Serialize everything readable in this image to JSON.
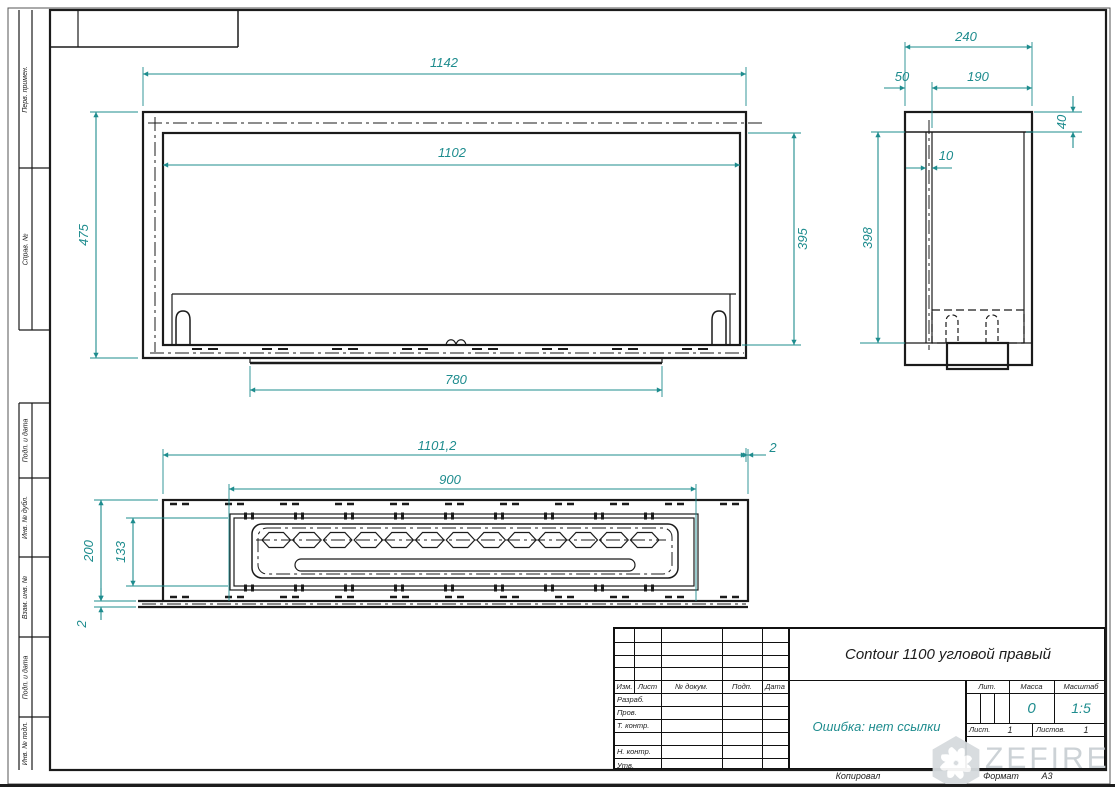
{
  "margin_labels": {
    "perv": "Перв. примен.",
    "sprav": "Справ. №",
    "podp1": "Подп. и дата",
    "inv_dubl": "Инв. № дубл.",
    "vzam": "Взам. инв. №",
    "podp2": "Подп. и дата",
    "inv_podl": "Инв. № подл."
  },
  "views": {
    "front": {
      "dim_width": "1142",
      "dim_inner_width": "1102",
      "dim_height": "475",
      "dim_inner_height": "395",
      "dim_bottom": "780"
    },
    "side": {
      "dim_depth": "240",
      "dim_50": "50",
      "dim_190": "190",
      "dim_40": "40",
      "dim_10": "10",
      "dim_height": "398"
    },
    "top": {
      "dim_length": "1101,2",
      "dim_burner": "900",
      "dim_right": "2",
      "dim_depth": "200",
      "dim_inner": "133",
      "dim_offset": "2"
    }
  },
  "title_block": {
    "title": "Contour 1100 угловой правый",
    "error_text": "Ошибка: нет ссылки",
    "col_izm": "Изм.",
    "col_list": "Лист",
    "col_dokum": "№ докум.",
    "col_podp": "Подп.",
    "col_data": "Дата",
    "row_razrab": "Разраб.",
    "row_prov": "Пров.",
    "row_tkontr": "Т. контр.",
    "row_nkontr": "Н. контр.",
    "row_utv": "Утв.",
    "lit_label": "Лит.",
    "massa_label": "Масса",
    "masshtab_label": "Масштаб",
    "massa_value": "0",
    "masshtab_value": "1:5",
    "list_label": "Лист.",
    "list_value": "1",
    "listov_label": "Листов.",
    "listov_value": "1"
  },
  "footer": {
    "kopiroval": "Копировал",
    "format_label": "Формат",
    "format_value": "А3"
  },
  "watermark": {
    "text": "ZEFIRE"
  },
  "colors": {
    "dim": "#1e8c8e",
    "line": "#1b1b1b",
    "watermark": "#d6dbde"
  }
}
